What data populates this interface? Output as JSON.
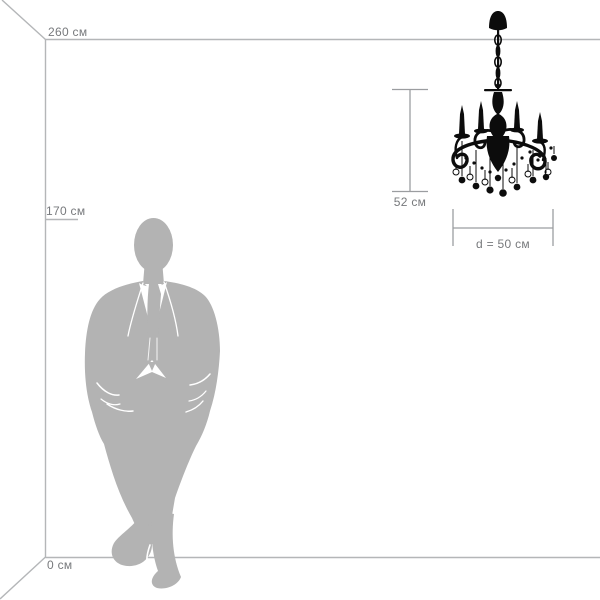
{
  "diagram": {
    "type": "product-size-diagram",
    "product": "chandelier",
    "room": {
      "ceiling_label": "260 см",
      "person_height_label": "170 см",
      "floor_label": "0 см",
      "ceiling_height_cm": 260,
      "person_height_cm": 170
    },
    "product_dimensions": {
      "height_label": "52 см",
      "height_cm": 52,
      "diameter_label": "d = 50 см",
      "diameter_cm": 50
    }
  },
  "colors": {
    "background": "#ffffff",
    "room-line": "#b4b6b8",
    "dimension-line": "#9b9da0",
    "label-text": "#77797c",
    "silhouette": "#b3b3b3",
    "product-ink": "#0c0c0c"
  }
}
